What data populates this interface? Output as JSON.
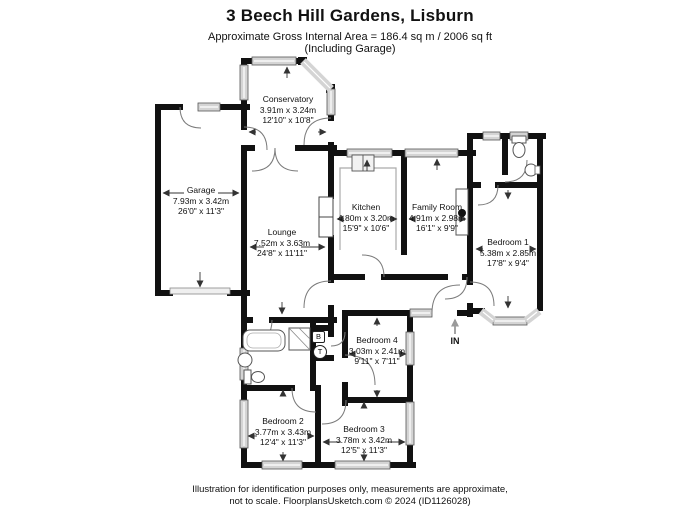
{
  "header": {
    "title": "3 Beech Hill Gardens, Lisburn",
    "area_line": "Approximate Gross Internal Area = 186.4 sq m / 2006 sq ft",
    "area_line2": "(Including Garage)"
  },
  "rooms": [
    {
      "name": "Conservatory",
      "metric": "3.91m x 3.24m",
      "imperial": "12'10\" x 10'8\""
    },
    {
      "name": "Garage",
      "metric": "7.93m x 3.42m",
      "imperial": "26'0\" x 11'3\""
    },
    {
      "name": "Lounge",
      "metric": "7.52m x 3.63m",
      "imperial": "24'8\" x 11'11\""
    },
    {
      "name": "Kitchen",
      "metric": "4.80m x 3.20m",
      "imperial": "15'9\" x 10'6\""
    },
    {
      "name": "Family Room",
      "metric": "4.91m x 2.98m",
      "imperial": "16'1\" x 9'9\""
    },
    {
      "name": "Bedroom 1",
      "metric": "5.38m x 2.85m",
      "imperial": "17'8\" x 9'4\""
    },
    {
      "name": "Bedroom 4",
      "metric": "3.03m x 2.41m",
      "imperial": "9'11\" x 7'11\""
    },
    {
      "name": "Bedroom 2",
      "metric": "3.77m x 3.43m",
      "imperial": "12'4\" x 11'3\""
    },
    {
      "name": "Bedroom 3",
      "metric": "3.78m x 3.42m",
      "imperial": "12'5\" x 11'3\""
    }
  ],
  "markers": {
    "entrance": "IN",
    "boiler": "B",
    "tank": "T"
  },
  "footer": {
    "line1": "Illustration for identification purposes only, measurements are approximate,",
    "line2": "not to scale. FloorplansUsketch.com © 2024 (ID1126028)"
  },
  "colors": {
    "wall": "#111111",
    "window_fill": "#d4d4d4",
    "text": "#111111"
  }
}
